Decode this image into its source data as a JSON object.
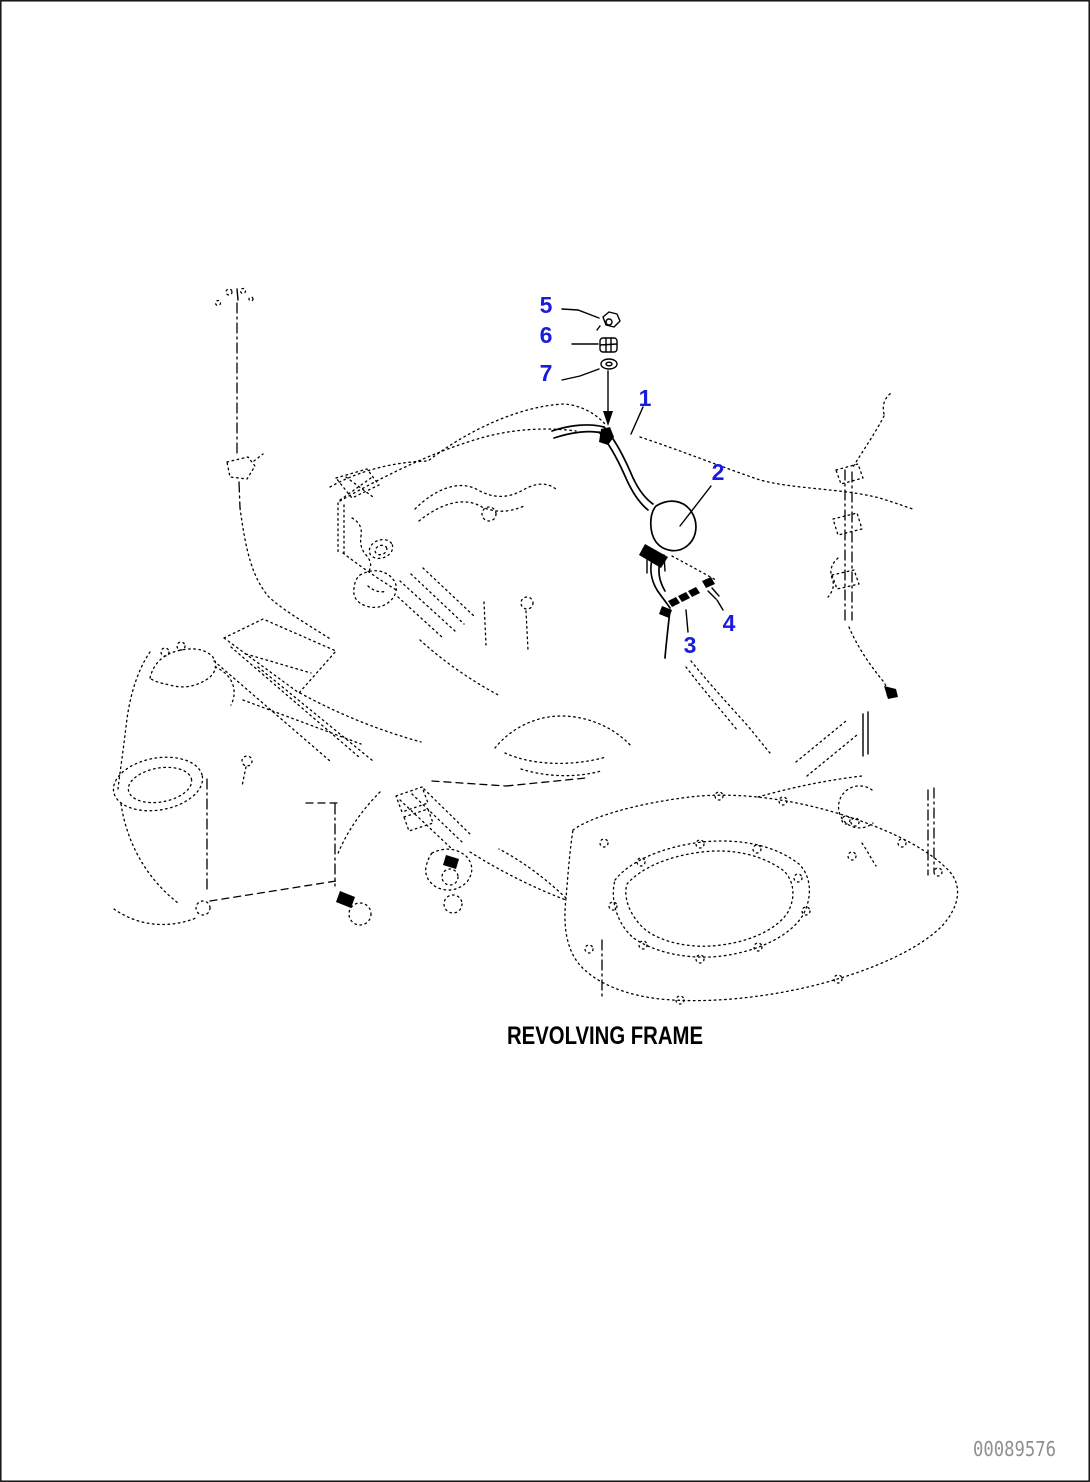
{
  "page": {
    "title": "REVOLVING FRAME",
    "doc_number": "00089576"
  },
  "colors": {
    "callout_blue": "#1b1be0",
    "line_black": "#000000",
    "doc_number_gray": "#909090",
    "background": "#ffffff"
  },
  "callouts": [
    {
      "label": "1"
    },
    {
      "label": "2"
    },
    {
      "label": "3"
    },
    {
      "label": "4"
    },
    {
      "label": "5"
    },
    {
      "label": "6"
    },
    {
      "label": "7"
    }
  ]
}
